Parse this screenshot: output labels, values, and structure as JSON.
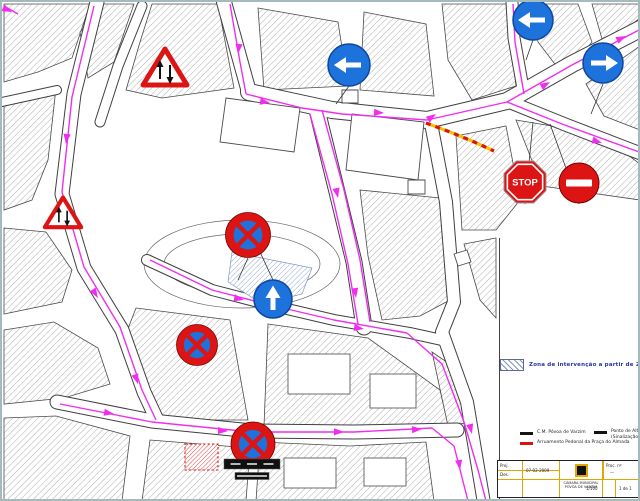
{
  "title": "Planta de alteração de trânsito - Praça do Almada",
  "colors": {
    "road": "#3f3f3f",
    "outline": "#4a4a4a",
    "hatch": "#9a9a9a",
    "route": "#ee2fee",
    "sign_red": "#dc1414",
    "sign_blue": "#1d72dc",
    "sign_blue_dark": "#0c479c",
    "zone": "#8095c2",
    "closed_red": "#d81414",
    "closed_yellow": "#f2c400",
    "legend_text": "#2333aa",
    "panel": "#101010",
    "title_grid": "#e2a600",
    "frame": "#a5baba"
  },
  "legend": {
    "zone_label": "Zona de intervenção a partir de 28/02/2009",
    "entries": [
      {
        "swatch": "black",
        "label": "C.M. Póvoa de Varzim"
      },
      {
        "swatch": "red",
        "label": "Arruamento Pedonal da Praça do Almada"
      },
      {
        "swatch": "black",
        "label": "Ponto de Alteração de Trânsito",
        "label2": "(Sinalização a partir de 28-02-09)"
      }
    ]
  },
  "title_block": {
    "row1_label": "Proj.",
    "row2_label": "Des.",
    "date": "07-02-2009",
    "org_line1": "CÂMARA MUNICIPAL",
    "org_line2": "PÓVOA DE VARZIM",
    "proc_label": "Proc. nº",
    "proc_value": "—",
    "scale": "1/500",
    "sheet": "1 de 1"
  },
  "map": {
    "stop_text": "STOP",
    "blocks": [
      [
        [
          2,
          2
        ],
        [
          88,
          2
        ],
        [
          70,
          56
        ],
        [
          36,
          70
        ],
        [
          2,
          80
        ]
      ],
      [
        [
          102,
          2
        ],
        [
          132,
          2
        ],
        [
          112,
          60
        ],
        [
          86,
          76
        ],
        [
          78,
          30
        ]
      ],
      [
        [
          150,
          2
        ],
        [
          216,
          2
        ],
        [
          232,
          86
        ],
        [
          160,
          96
        ],
        [
          124,
          88
        ],
        [
          138,
          40
        ]
      ],
      [
        [
          2,
          96
        ],
        [
          54,
          86
        ],
        [
          46,
          158
        ],
        [
          30,
          198
        ],
        [
          2,
          208
        ]
      ],
      [
        [
          2,
          226
        ],
        [
          44,
          230
        ],
        [
          70,
          268
        ],
        [
          60,
          300
        ],
        [
          2,
          312
        ]
      ],
      [
        [
          2,
          328
        ],
        [
          52,
          320
        ],
        [
          96,
          346
        ],
        [
          108,
          382
        ],
        [
          62,
          396
        ],
        [
          2,
          402
        ]
      ],
      [
        [
          2,
          416
        ],
        [
          54,
          414
        ],
        [
          128,
          434
        ],
        [
          120,
          499
        ],
        [
          2,
          499
        ]
      ],
      [
        [
          148,
          438
        ],
        [
          248,
          446
        ],
        [
          244,
          499
        ],
        [
          140,
          499
        ]
      ],
      [
        [
          134,
          306
        ],
        [
          228,
          318
        ],
        [
          246,
          418
        ],
        [
          152,
          418
        ],
        [
          120,
          342
        ]
      ],
      [
        [
          266,
          322
        ],
        [
          366,
          336
        ],
        [
          438,
          388
        ],
        [
          446,
          422
        ],
        [
          352,
          428
        ],
        [
          262,
          424
        ]
      ],
      [
        [
          358,
          188
        ],
        [
          438,
          196
        ],
        [
          448,
          298
        ],
        [
          418,
          314
        ],
        [
          380,
          318
        ],
        [
          366,
          254
        ]
      ],
      [
        [
          256,
          6
        ],
        [
          336,
          20
        ],
        [
          346,
          84
        ],
        [
          262,
          88
        ]
      ],
      [
        [
          362,
          10
        ],
        [
          424,
          22
        ],
        [
          432,
          94
        ],
        [
          358,
          88
        ]
      ],
      [
        [
          440,
          2
        ],
        [
          504,
          2
        ],
        [
          514,
          84
        ],
        [
          470,
          98
        ],
        [
          446,
          58
        ]
      ],
      [
        [
          530,
          2
        ],
        [
          576,
          2
        ],
        [
          590,
          40
        ],
        [
          562,
          74
        ],
        [
          536,
          40
        ]
      ],
      [
        [
          590,
          2
        ],
        [
          638,
          2
        ],
        [
          638,
          16
        ],
        [
          602,
          44
        ]
      ],
      [
        [
          584,
          82
        ],
        [
          638,
          44
        ],
        [
          638,
          128
        ],
        [
          602,
          114
        ]
      ],
      [
        [
          514,
          118
        ],
        [
          598,
          132
        ],
        [
          638,
          162
        ],
        [
          638,
          198
        ],
        [
          540,
          184
        ]
      ],
      [
        [
          454,
          134
        ],
        [
          504,
          124
        ],
        [
          518,
          198
        ],
        [
          494,
          228
        ],
        [
          460,
          228
        ]
      ],
      [
        [
          462,
          242
        ],
        [
          494,
          236
        ],
        [
          494,
          316
        ],
        [
          478,
          298
        ]
      ],
      [
        [
          430,
          350
        ],
        [
          452,
          365
        ],
        [
          468,
          420
        ],
        [
          446,
          424
        ]
      ],
      [
        [
          258,
          440
        ],
        [
          348,
          444
        ],
        [
          424,
          440
        ],
        [
          432,
          499
        ],
        [
          254,
          499
        ]
      ]
    ],
    "garden_arcs": [
      {
        "cx": 240,
        "cy": 262,
        "rx": 98,
        "ry": 44
      },
      {
        "cx": 240,
        "cy": 262,
        "rx": 78,
        "ry": 30
      }
    ],
    "plaza_outlines": [
      [
        [
          224,
          96
        ],
        [
          298,
          106
        ],
        [
          292,
          150
        ],
        [
          218,
          140
        ]
      ],
      [
        [
          350,
          112
        ],
        [
          422,
          120
        ],
        [
          416,
          178
        ],
        [
          344,
          168
        ]
      ],
      [
        [
          340,
          88
        ],
        [
          356,
          88
        ],
        [
          356,
          101
        ],
        [
          340,
          101
        ]
      ],
      [
        [
          406,
          178
        ],
        [
          423,
          178
        ],
        [
          423,
          192
        ],
        [
          406,
          192
        ]
      ],
      [
        [
          452,
          252
        ],
        [
          465,
          248
        ],
        [
          469,
          260
        ],
        [
          456,
          264
        ]
      ]
    ],
    "roads": [
      {
        "p": [
          [
            222,
            0
          ],
          [
            247,
            90
          ]
        ],
        "w": 14
      },
      {
        "p": [
          [
            247,
            90
          ],
          [
            330,
            108
          ],
          [
            425,
            118
          ],
          [
            505,
            99
          ],
          [
            570,
            62
          ],
          [
            640,
            26
          ]
        ],
        "w": 16
      },
      {
        "p": [
          [
            505,
            99
          ],
          [
            562,
            122
          ],
          [
            640,
            152
          ]
        ],
        "w": 12
      },
      {
        "p": [
          [
            522,
            92
          ],
          [
            512,
            36
          ],
          [
            510,
            0
          ]
        ],
        "w": 11
      },
      {
        "p": [
          [
            95,
            0
          ],
          [
            72,
            92
          ],
          [
            60,
            192
          ],
          [
            82,
            266
          ],
          [
            120,
            328
          ],
          [
            142,
            390
          ],
          [
            155,
            418
          ]
        ],
        "w": 13
      },
      {
        "p": [
          [
            140,
            4
          ],
          [
            116,
            64
          ],
          [
            98,
            120
          ]
        ],
        "w": 9
      },
      {
        "p": [
          [
            315,
            108
          ],
          [
            335,
            190
          ],
          [
            352,
            260
          ],
          [
            362,
            325
          ]
        ],
        "w": 15
      },
      {
        "p": [
          [
            428,
            116
          ],
          [
            444,
            200
          ],
          [
            452,
            300
          ],
          [
            440,
            330
          ],
          [
            465,
            400
          ],
          [
            482,
            501
          ]
        ],
        "w": 12
      },
      {
        "p": [
          [
            55,
            400
          ],
          [
            150,
            419
          ],
          [
            250,
            429
          ],
          [
            352,
            430
          ],
          [
            455,
            428
          ]
        ],
        "w": 13
      },
      {
        "p": [
          [
            145,
            258
          ],
          [
            210,
            288
          ],
          [
            268,
            303
          ],
          [
            332,
            318
          ],
          [
            408,
            331
          ],
          [
            440,
            338
          ]
        ],
        "w": 10
      },
      {
        "p": [
          [
            0,
            100
          ],
          [
            55,
            88
          ]
        ],
        "w": 8
      }
    ],
    "courtyards": [
      [
        286,
        352,
        62,
        40
      ],
      [
        368,
        372,
        46,
        34
      ],
      [
        282,
        456,
        52,
        30
      ],
      [
        362,
        456,
        42,
        28
      ]
    ],
    "zone_poly": [
      [
        230,
        250
      ],
      [
        310,
        266
      ],
      [
        300,
        292
      ],
      [
        260,
        302
      ],
      [
        226,
        280
      ]
    ],
    "red_hatch_rect": [
      183,
      442,
      33,
      26
    ],
    "closed_segment": [
      [
        424,
        121
      ],
      [
        448,
        130
      ],
      [
        470,
        139
      ],
      [
        492,
        149
      ]
    ],
    "routes": [
      [
        [
          228,
          2
        ],
        [
          238,
          60
        ],
        [
          244,
          92
        ]
      ],
      [
        [
          244,
          92
        ],
        [
          300,
          106
        ],
        [
          340,
          112
        ],
        [
          425,
          118
        ],
        [
          505,
          100
        ],
        [
          570,
          63
        ],
        [
          637,
          28
        ]
      ],
      [
        [
          505,
          100
        ],
        [
          560,
          122
        ],
        [
          637,
          150
        ]
      ],
      [
        [
          522,
          92
        ],
        [
          513,
          40
        ],
        [
          511,
          2
        ]
      ],
      [
        [
          308,
          112
        ],
        [
          330,
          192
        ],
        [
          346,
          262
        ],
        [
          356,
          322
        ]
      ],
      [
        [
          320,
          108
        ],
        [
          342,
          188
        ],
        [
          358,
          258
        ],
        [
          368,
          320
        ]
      ],
      [
        [
          92,
          4
        ],
        [
          70,
          95
        ],
        [
          60,
          190
        ],
        [
          82,
          265
        ],
        [
          118,
          325
        ],
        [
          140,
          388
        ],
        [
          154,
          418
        ]
      ],
      [
        [
          58,
          402
        ],
        [
          150,
          420
        ],
        [
          250,
          430
        ],
        [
          352,
          430
        ],
        [
          430,
          426
        ]
      ],
      [
        [
          430,
          426
        ],
        [
          452,
          444
        ],
        [
          466,
          499
        ]
      ],
      [
        [
          148,
          258
        ],
        [
          210,
          288
        ],
        [
          268,
          303
        ],
        [
          332,
          318
        ],
        [
          405,
          331
        ]
      ],
      [
        [
          405,
          331
        ],
        [
          440,
          362
        ],
        [
          462,
          420
        ],
        [
          476,
          468
        ],
        [
          484,
          499
        ]
      ],
      [
        [
          2,
          4
        ],
        [
          16,
          12
        ]
      ]
    ],
    "arrows": [
      [
        10,
        10,
        25
      ],
      [
        236,
        52,
        96
      ],
      [
        268,
        101,
        10
      ],
      [
        382,
        111,
        4
      ],
      [
        548,
        80,
        -30
      ],
      [
        624,
        34,
        -26
      ],
      [
        514,
        16,
        -96
      ],
      [
        600,
        141,
        18
      ],
      [
        336,
        196,
        78
      ],
      [
        354,
        296,
        82
      ],
      [
        64,
        142,
        96
      ],
      [
        96,
        296,
        58
      ],
      [
        136,
        382,
        72
      ],
      [
        112,
        412,
        10
      ],
      [
        226,
        429,
        3
      ],
      [
        342,
        430,
        1
      ],
      [
        420,
        427,
        -4
      ],
      [
        458,
        468,
        82
      ],
      [
        242,
        298,
        13
      ],
      [
        362,
        327,
        9
      ],
      [
        434,
        112,
        -35
      ],
      [
        470,
        432,
        76
      ]
    ],
    "leaders": [
      [
        523,
        202,
        531,
        120
      ],
      [
        577,
        202,
        548,
        122
      ],
      [
        347,
        84,
        334,
        102
      ],
      [
        271,
        278,
        258,
        250
      ],
      [
        246,
        256,
        236,
        278
      ],
      [
        531,
        38,
        524,
        58
      ],
      [
        601,
        82,
        589,
        112
      ]
    ],
    "signs": [
      {
        "type": "two_way_warning",
        "x": 163,
        "y": 67,
        "s": 46
      },
      {
        "type": "two_way_warning",
        "x": 61,
        "y": 212,
        "s": 38
      },
      {
        "type": "mandatory_left",
        "x": 347,
        "y": 63,
        "s": 42
      },
      {
        "type": "mandatory_left",
        "x": 531,
        "y": 18,
        "s": 40
      },
      {
        "type": "mandatory_right",
        "x": 601,
        "y": 61,
        "s": 40
      },
      {
        "type": "stop",
        "x": 523,
        "y": 180,
        "s": 42
      },
      {
        "type": "no_entry",
        "x": 577,
        "y": 181,
        "s": 40
      },
      {
        "type": "no_stopping",
        "x": 246,
        "y": 233,
        "s": 45
      },
      {
        "type": "ahead_only",
        "x": 271,
        "y": 297,
        "s": 38
      },
      {
        "type": "no_stopping",
        "x": 195,
        "y": 343,
        "s": 41
      },
      {
        "type": "no_stopping",
        "x": 251,
        "y": 442,
        "s": 44
      },
      {
        "type": "panel",
        "x": 250,
        "y": 462,
        "w": 56,
        "h": 10
      },
      {
        "type": "panel",
        "x": 250,
        "y": 474,
        "w": 34,
        "h": 7
      }
    ],
    "margin": {
      "x": 498,
      "y": 230,
      "w": 142,
      "h": 271,
      "sep_x": 497.5,
      "sep_y1": 236,
      "sep_y2": 497
    }
  }
}
